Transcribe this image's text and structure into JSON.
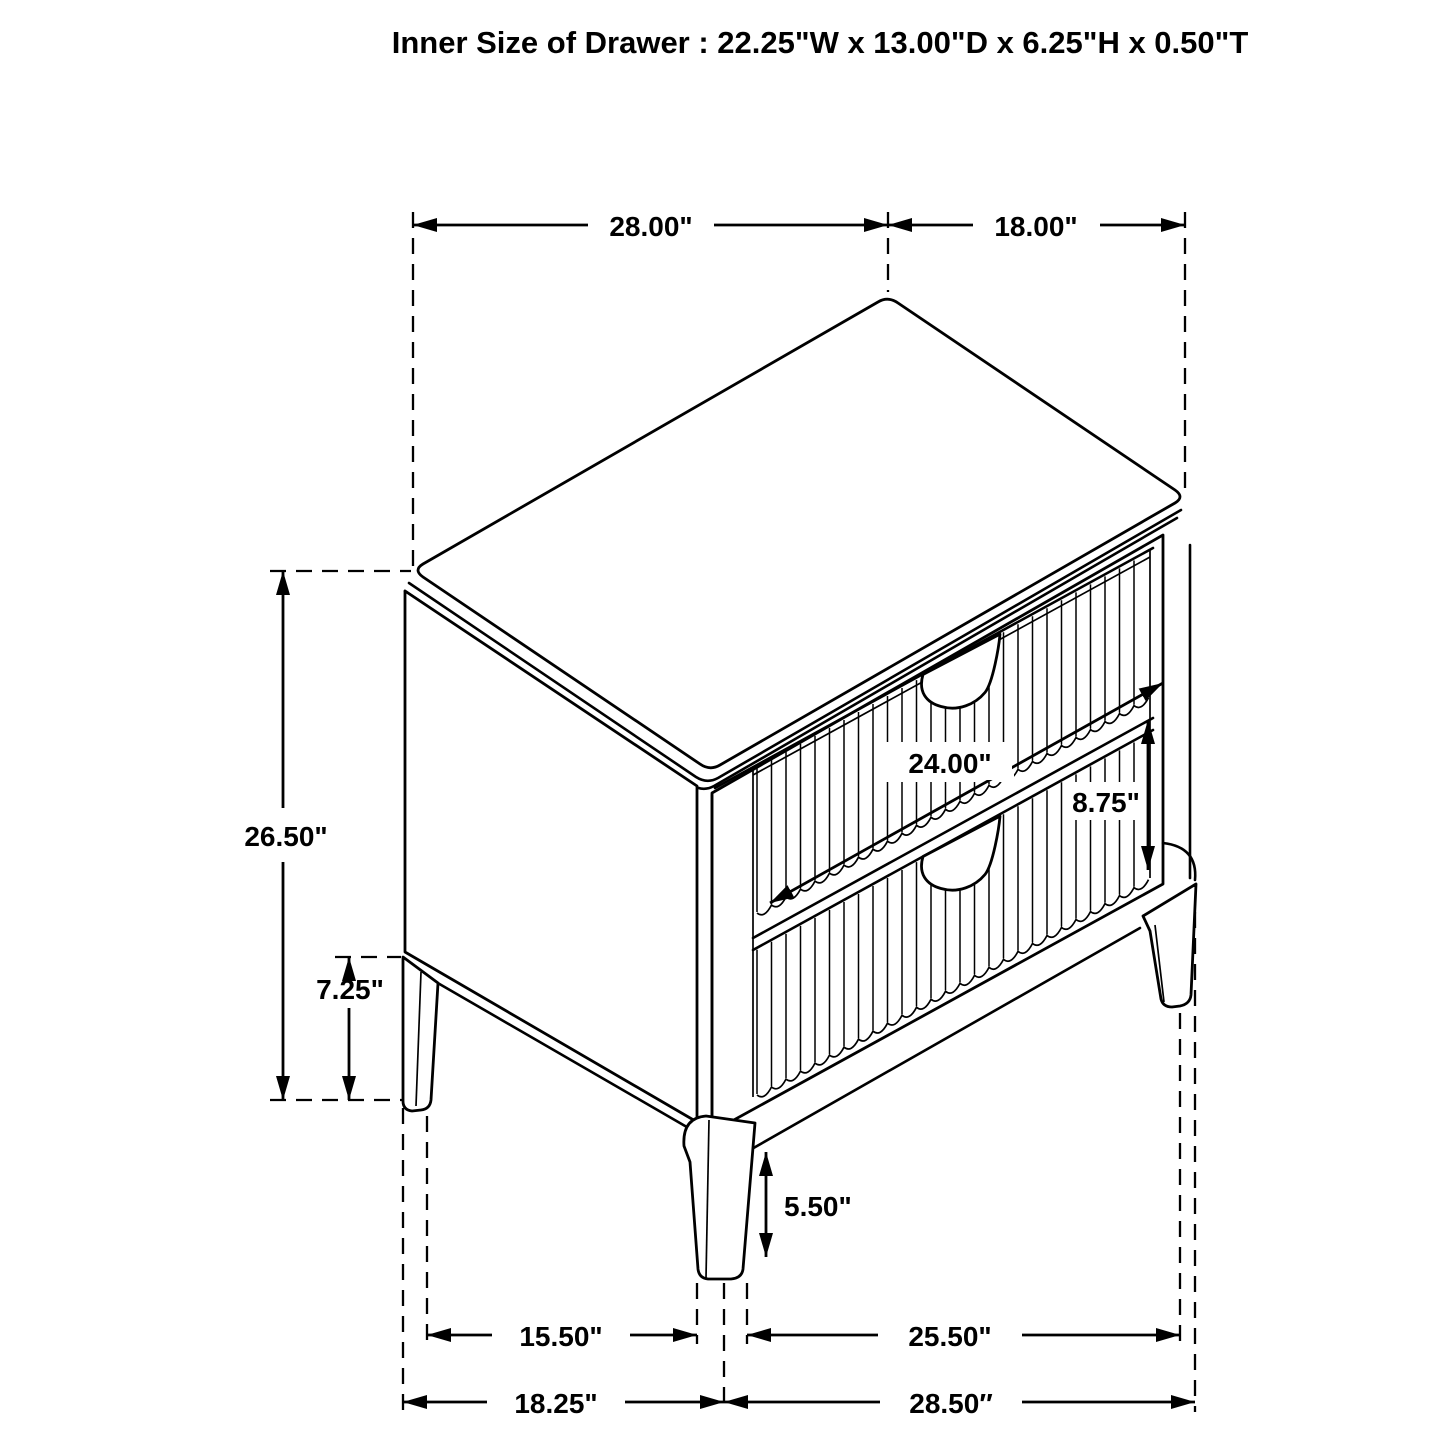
{
  "title": "Inner Size of Drawer : 22.25\"W x 13.00\"D x 6.25\"H x 0.50\"T",
  "dims": {
    "top_width": "28.00\"",
    "top_depth": "18.00\"",
    "overall_height": "26.50\"",
    "leg_clearance": "7.25\"",
    "drawer_width": "24.00\"",
    "drawer_front_height": "8.75\"",
    "front_leg_height": "5.50\"",
    "base_span_front_left": "15.50\"",
    "base_span_front_right": "25.50\"",
    "base_depth": "18.25\"",
    "base_width": "28.50″"
  }
}
